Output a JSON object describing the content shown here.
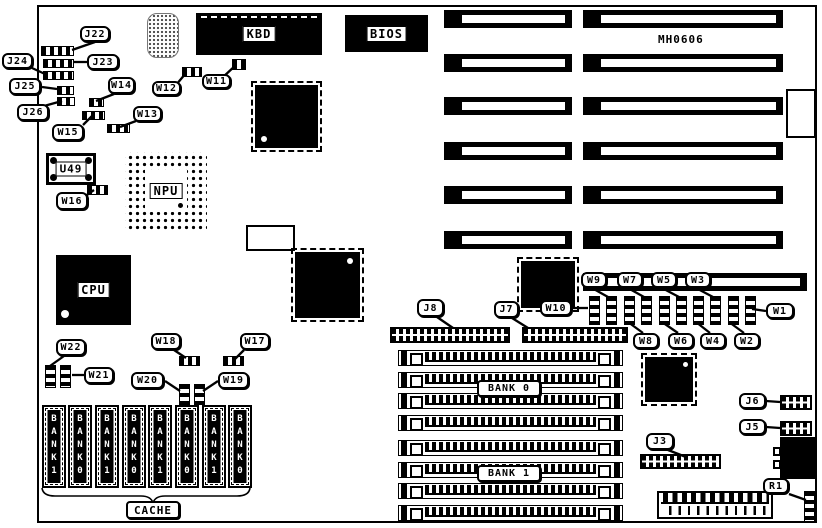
{
  "board": {
    "model": "MH0606"
  },
  "chips": {
    "kbd": "KBD",
    "bios": "BIOS",
    "npu": "NPU",
    "cpu": "CPU",
    "u49": "U49"
  },
  "memory": {
    "bank0": "BANK 0",
    "bank1": "BANK 1"
  },
  "cache": {
    "label": "CACHE",
    "banks": [
      "BANK1",
      "BANK0",
      "BANK1",
      "BANK0",
      "BANK1",
      "BANK0",
      "BANK1",
      "BANK0"
    ]
  },
  "callouts": {
    "j22": "J22",
    "j23": "J23",
    "j24": "J24",
    "j25": "J25",
    "j26": "J26",
    "w11": "W11",
    "w12": "W12",
    "w13": "W13",
    "w14": "W14",
    "w15": "W15",
    "w16": "W16",
    "w17": "W17",
    "w18": "W18",
    "w19": "W19",
    "w20": "W20",
    "w21": "W21",
    "w22": "W22",
    "w1": "W1",
    "w2": "W2",
    "w3": "W3",
    "w4": "W4",
    "w5": "W5",
    "w6": "W6",
    "w7": "W7",
    "w8": "W8",
    "w9": "W9",
    "w10": "W10",
    "j3": "J3",
    "j5": "J5",
    "j6": "J6",
    "j7": "J7",
    "j8": "J8",
    "r1": "R1"
  }
}
